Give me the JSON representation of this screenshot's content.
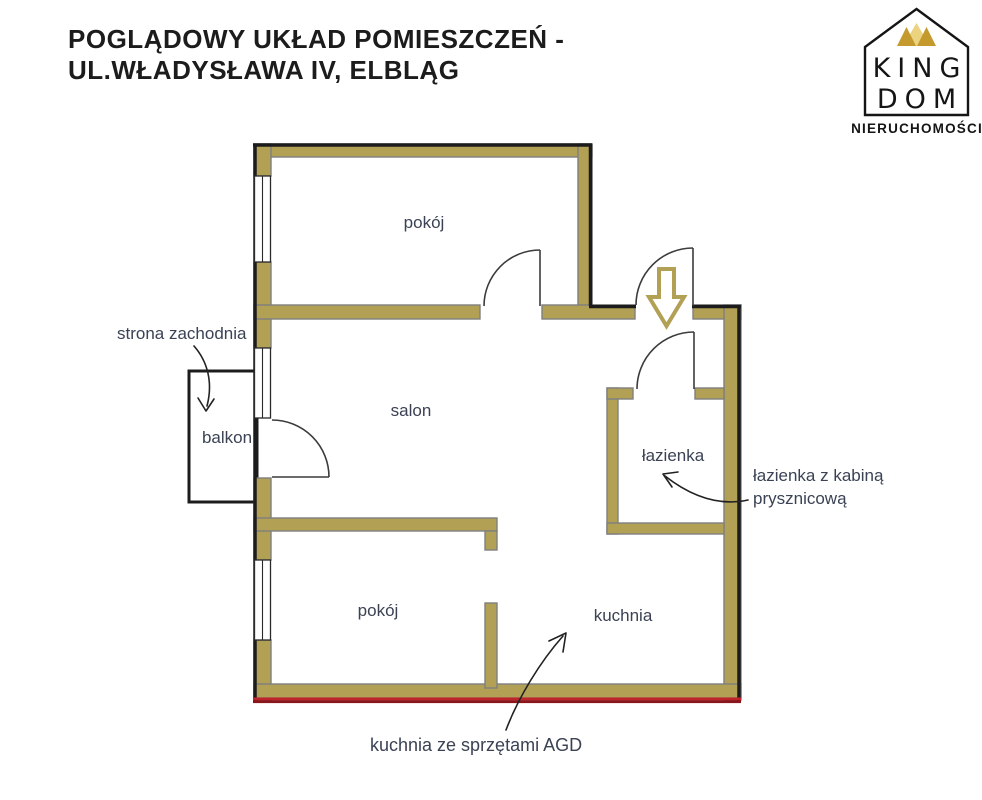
{
  "title": {
    "line1": "POGLĄDOWY UKŁAD POMIESZCZEŃ -",
    "line2": "UL.WŁADYSŁAWA IV, ELBLĄG"
  },
  "logo": {
    "king": "KING",
    "dom": "DOM",
    "subtitle": "NIERUCHOMOŚCI"
  },
  "rooms": {
    "room_top": "pokój",
    "salon": "salon",
    "balcony": "balkon",
    "bathroom": "łazienka",
    "room_bottom": "pokój",
    "kitchen": "kuchnia"
  },
  "annotations": {
    "west_side": "strona zachodnia",
    "bathroom_note_line1": "łazienka z kabiną",
    "bathroom_note_line2": "prysznicową",
    "kitchen_note": "kuchnia ze sprzętami AGD"
  },
  "colors": {
    "wall_fill": "#b2a055",
    "wall_inner_line": "#7f7f7f",
    "outline_black": "#1c1c1c",
    "foundation_red": "#9e1b23",
    "label_text": "#3a4254",
    "title_text": "#1c1c1c",
    "arrow_gold": "#b2a055",
    "crown_gold_dark": "#c49a2e",
    "crown_gold_light": "#ecd37f"
  }
}
